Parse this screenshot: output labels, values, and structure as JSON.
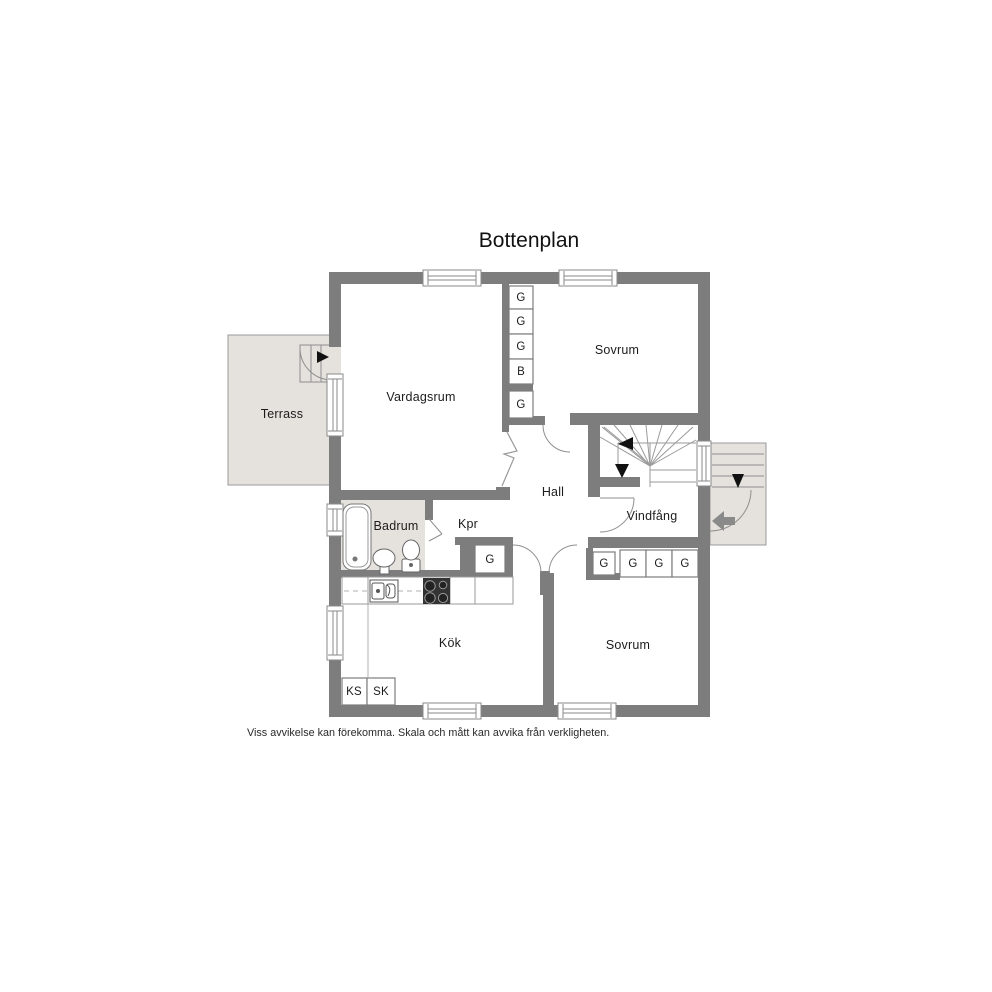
{
  "title": "Bottenplan",
  "disclaimer": "Viss avvikelse kan förekomma. Skala och mått kan avvika från verkligheten.",
  "rooms": {
    "terrass": "Terrass",
    "vardagsrum": "Vardagsrum",
    "sovrum_top": "Sovrum",
    "hall": "Hall",
    "badrum": "Badrum",
    "kpr": "Kpr",
    "vindfang": "Vindfång",
    "kok": "Kök",
    "sovrum_bottom": "Sovrum"
  },
  "closets": {
    "column": [
      "G",
      "G",
      "G",
      "B",
      "G"
    ],
    "near_kpr": "G",
    "bottom_row": [
      "G",
      "G",
      "G",
      "G"
    ],
    "kitchen_left": [
      "KS",
      "SK"
    ]
  },
  "colors": {
    "wall": "#7d7d7d",
    "outdoor_floor": "#e5e1dc",
    "thin_line": "#999999",
    "text": "#1c1c1c"
  }
}
